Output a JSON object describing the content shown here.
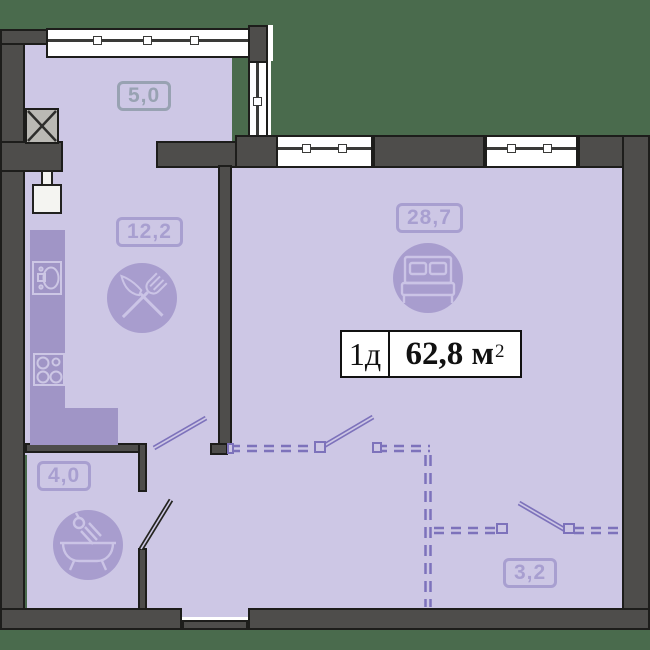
{
  "plan": {
    "title": {
      "type_label": "1д",
      "area_value": "62,8",
      "area_unit": "м",
      "area_sup": "2"
    },
    "rooms": {
      "balcony": {
        "area": "5,0"
      },
      "kitchen": {
        "area": "12,2"
      },
      "living": {
        "area": "28,7"
      },
      "bathroom": {
        "area": "4,0"
      },
      "wardrobe": {
        "area": "3,2"
      }
    },
    "icons": {
      "kitchen": "fork-knife-icon",
      "living": "bed-icon",
      "bathroom": "bathtub-icon",
      "counter_items": [
        "sink-icon",
        "stove-icon"
      ],
      "shaft": "x-shaft-icon",
      "riser": "riser-box-icon"
    },
    "colors": {
      "background": "#4a6b4d",
      "wall": "#4e4d4b",
      "floor": "#cdc7e5",
      "furniture_accent": "#a095c6",
      "icon_circle": "#a89dce",
      "label_purple": "#a89fd0",
      "label_gray": "#98a2b2",
      "dashed_partition": "#7d72bb"
    }
  }
}
